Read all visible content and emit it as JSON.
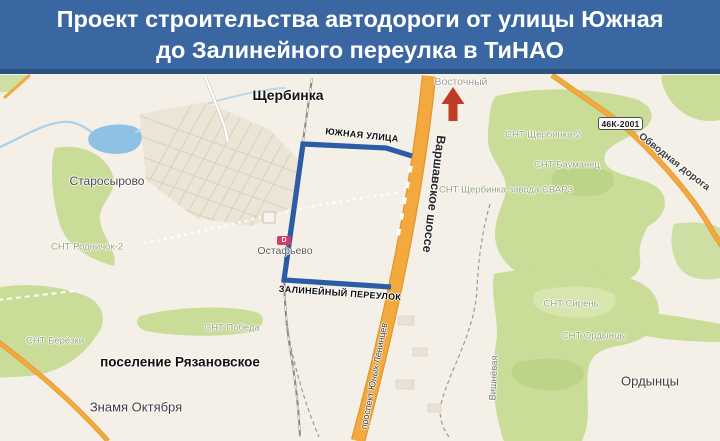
{
  "header": {
    "line1": "Проект строительства автодороги от улицы Южная",
    "line2": "до Залинейного переулка в ТиНАО"
  },
  "map": {
    "shield_label": "46К-2001",
    "station_badge": "D",
    "colors": {
      "header_bg": "#3a67a2",
      "header_edge": "#2b5181",
      "route_blue": "#2d5ca6",
      "road_orange": "#f4a93f",
      "road_orange_casing": "#e0982e",
      "forest_green": "#c9dc98",
      "water_blue": "#8fc2e2",
      "arrow_red": "#c23b26",
      "map_bg": "#f4f0e7"
    },
    "labels": [
      {
        "id": "city-shcherbinka",
        "t": "Щербинка",
        "x": 288,
        "y": 95,
        "s": 14,
        "w": 700,
        "c": "#141414"
      },
      {
        "id": "district-vostochny",
        "t": "Восточный",
        "x": 461,
        "y": 82,
        "s": 10.5,
        "w": 400,
        "c": "#9c9c9c"
      },
      {
        "id": "town-starosyrovo",
        "t": "Старосырово",
        "x": 107,
        "y": 181,
        "s": 12,
        "w": 400,
        "c": "#474747"
      },
      {
        "id": "snt-rodnichok-2",
        "t": "СНТ Родничок-2",
        "x": 87,
        "y": 247,
        "s": 9.5,
        "w": 400,
        "c": "#97a37b"
      },
      {
        "id": "town-ostafyevo",
        "t": "Остафьево",
        "x": 285,
        "y": 251,
        "s": 10.5,
        "w": 400,
        "c": "#5b5b5b"
      },
      {
        "id": "snt-pobeda",
        "t": "СНТ Победа",
        "x": 232,
        "y": 328,
        "s": 9.5,
        "w": 400,
        "c": "#97a37b"
      },
      {
        "id": "snt-beryozki",
        "t": "СНТ Берёзки",
        "x": 55,
        "y": 341,
        "s": 9.5,
        "w": 400,
        "c": "#97a37b"
      },
      {
        "id": "settlement-ryazanovskoe",
        "t": "поселение Рязановское",
        "x": 180,
        "y": 362,
        "s": 13.5,
        "w": 700,
        "c": "#101010"
      },
      {
        "id": "town-znamya-oktyabrya",
        "t": "Знамя Октября",
        "x": 136,
        "y": 407,
        "s": 13,
        "w": 400,
        "c": "#3d3d3d"
      },
      {
        "id": "snt-shcherbinka-2",
        "t": "СНТ Щербинка-2",
        "x": 543,
        "y": 135,
        "s": 9.5,
        "w": 400,
        "c": "#97a37b"
      },
      {
        "id": "snt-baumanets",
        "t": "СНТ Бауманец",
        "x": 567,
        "y": 165,
        "s": 9.5,
        "w": 400,
        "c": "#97a37b"
      },
      {
        "id": "snt-shcherbinka-svarz",
        "t": "СНТ Щербинка завода СВАРЗ",
        "x": 506,
        "y": 190,
        "s": 9.5,
        "w": 400,
        "c": "#97a37b"
      },
      {
        "id": "snt-siren",
        "t": "СНТ Сирень",
        "x": 571,
        "y": 304,
        "s": 9.5,
        "w": 400,
        "c": "#97a37b"
      },
      {
        "id": "snt-ordyntsy",
        "t": "СНТ Ордынцы",
        "x": 594,
        "y": 336,
        "s": 9.5,
        "w": 400,
        "c": "#97a37b"
      },
      {
        "id": "town-ordyntsy",
        "t": "Ордынцы",
        "x": 650,
        "y": 381,
        "s": 13,
        "w": 400,
        "c": "#3d3d3d"
      },
      {
        "id": "street-yuzhnaya-ulitsa",
        "t": "ЮЖНАЯ УЛИЦА",
        "x": 362,
        "y": 135,
        "s": 9,
        "w": 700,
        "c": "#0a0a0a",
        "r": 6,
        "ls": 0.3
      },
      {
        "id": "street-zalineyny-pereulok",
        "t": "ЗАЛИНЕЙНЫЙ ПЕРЕУЛОК",
        "x": 340,
        "y": 293,
        "s": 9,
        "w": 700,
        "c": "#0a0a0a",
        "r": 4,
        "ls": 0.3
      },
      {
        "id": "road-varshavskoe-shosse",
        "t": "Варшавское шоссе",
        "x": 434,
        "y": 194,
        "s": 12.5,
        "w": 700,
        "c": "#262626",
        "r": 97
      },
      {
        "id": "road-prospekt-yunykh-lenintsev",
        "t": "проспект Юных Ленинцев",
        "x": 374,
        "y": 376,
        "s": 9,
        "w": 400,
        "c": "#46423a",
        "r": -79
      },
      {
        "id": "road-vishnyovaya",
        "t": "Вишнёвая",
        "x": 494,
        "y": 378,
        "s": 9.5,
        "w": 400,
        "c": "#7c7c74",
        "r": -87
      },
      {
        "id": "road-obvodnaya-doroga",
        "t": "Обводная дорога",
        "x": 674,
        "y": 162,
        "s": 10,
        "w": 600,
        "c": "#3f3f3f",
        "r": 38
      }
    ]
  }
}
